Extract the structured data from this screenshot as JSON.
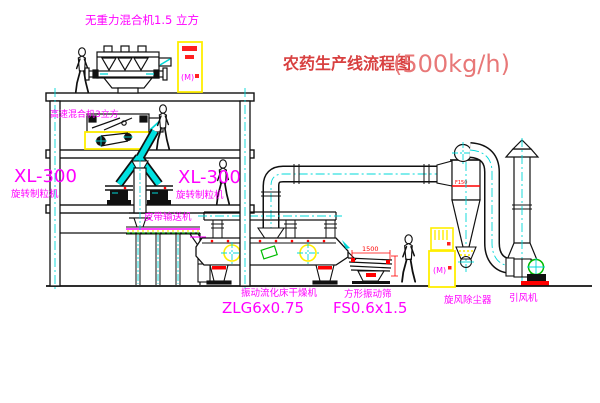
{
  "title": {
    "zh": "农药生产线流程图",
    "capacity": "(500kg/h)"
  },
  "labels": {
    "top_mixer": "无重力混合机1.5 立方",
    "high_speed_mixer": "高速混合机3立方",
    "granulator_left_model": "XL-300",
    "granulator_left_name": "旋转制粒机",
    "granulator_right_model": "XL-300",
    "granulator_right_name": "旋转制粒机",
    "belt_conveyor": "皮带输送机",
    "dryer_name": "振动流化床干燥机",
    "dryer_model": "ZLG6x0.75",
    "sieve_name": "方形振动筛",
    "sieve_model": "FS0.6x1.5",
    "sieve_dim": "1500",
    "cyclone_name": "旋风除尘器",
    "cyclone_tag": "F150",
    "fan_name": "引风机",
    "cabinet_top_mark": "(M)",
    "cabinet_right_mark": "(M)"
  },
  "colors": {
    "line": "#101010",
    "magenta": "#ff00ff",
    "cyan": "#00d8d8",
    "yellow": "#ffee00",
    "red": "#ff0000",
    "green": "#00bb00",
    "title_red": "#d84040",
    "title_light_red": "#e87878"
  }
}
